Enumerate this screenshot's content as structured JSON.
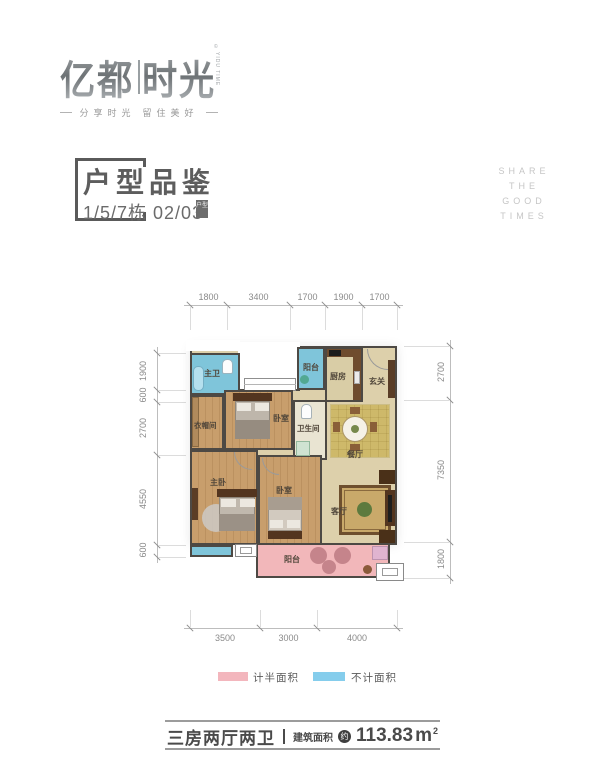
{
  "logo": {
    "brand_left": "亿都",
    "brand_right": "时光",
    "brand_side": "YIDU TIME",
    "copyright": "©",
    "tagline_left": "分享时光",
    "tagline_right": "留住美好"
  },
  "header": {
    "title": "户型品鉴",
    "subtitle": "1/5/7栋 02/03",
    "subtitle_tag": "户型"
  },
  "side_text": {
    "line1": "SHARE",
    "line2": "THE",
    "line3": "GOOD",
    "line4": "TIMES"
  },
  "plan": {
    "rooms": [
      {
        "label": "主卫"
      },
      {
        "label": "阳台"
      },
      {
        "label": "厨房"
      },
      {
        "label": "玄关"
      },
      {
        "label": "衣帽间"
      },
      {
        "label": "卧室"
      },
      {
        "label": "卫生间"
      },
      {
        "label": "餐厅"
      },
      {
        "label": "主卧"
      },
      {
        "label": "卧室"
      },
      {
        "label": "客厅"
      },
      {
        "label": "阳台"
      }
    ],
    "dims": {
      "top": [
        "1800",
        "3400",
        "1700",
        "1900",
        "1700"
      ],
      "left": [
        "1900",
        "600",
        "2700",
        "4550",
        "600"
      ],
      "right": [
        "2700",
        "7350",
        "1800"
      ],
      "bottom": [
        "3500",
        "3000",
        "4000"
      ]
    },
    "colors": {
      "wall": "#4d4944",
      "wood_floor": "#c89e6c",
      "tile_beige": "#ddd0ab",
      "water_blue": "#7fc5da",
      "balcony_pink": "#f2b7ba"
    }
  },
  "legend": {
    "items": [
      {
        "label": "计半面积",
        "color": "#f3b6bd"
      },
      {
        "label": "不计面积",
        "color": "#85cdec"
      }
    ]
  },
  "footer": {
    "layout_type": "三房两厅两卫",
    "area_label": "建筑面积",
    "area_approx": "约",
    "area_value": "113.83",
    "area_unit": "m",
    "area_exp": "2"
  }
}
